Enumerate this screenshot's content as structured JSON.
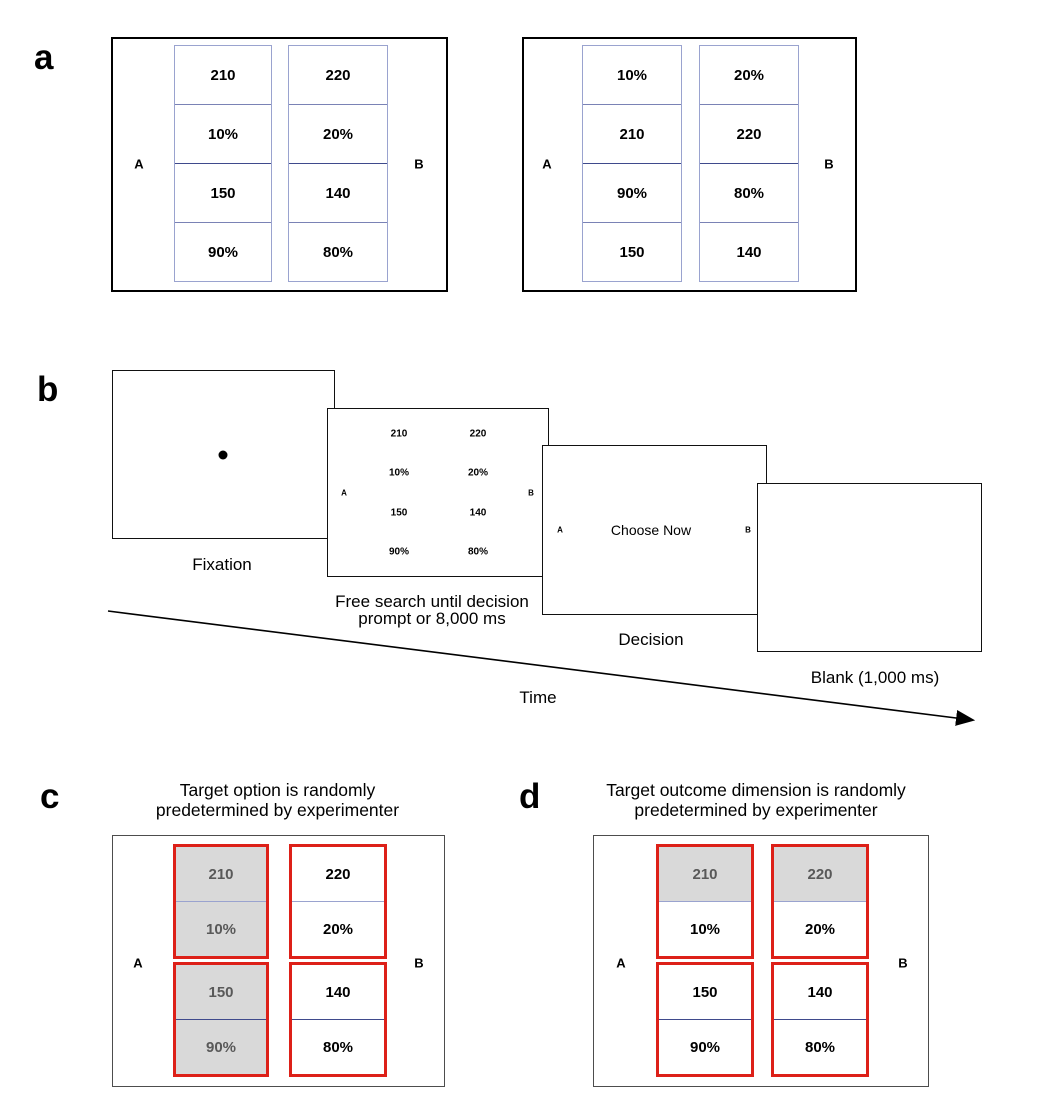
{
  "figure": {
    "panel_labels": {
      "a": "a",
      "b": "b",
      "c": "c",
      "d": "d"
    },
    "option_labels": {
      "A": "A",
      "B": "B"
    }
  },
  "panel_a": {
    "box1": {
      "colA": [
        "210",
        "10%",
        "150",
        "90%"
      ],
      "colB": [
        "220",
        "20%",
        "140",
        "80%"
      ]
    },
    "box2": {
      "colA": [
        "10%",
        "210",
        "90%",
        "150"
      ],
      "colB": [
        "20%",
        "220",
        "80%",
        "140"
      ]
    }
  },
  "panel_b": {
    "fixation_label": "Fixation",
    "search_label_line1": "Free search until decision",
    "search_label_line2": "prompt or 8,000 ms",
    "decision_label": "Decision",
    "blank_label": "Blank (1,000 ms)",
    "time_label": "Time",
    "choose_now": "Choose Now",
    "search_values": {
      "colA": [
        "210",
        "10%",
        "150",
        "90%"
      ],
      "colB": [
        "220",
        "20%",
        "140",
        "80%"
      ]
    }
  },
  "panel_c": {
    "title_line1": "Target option is randomly",
    "title_line2": "predetermined by experimenter",
    "colA": [
      "210",
      "10%",
      "150",
      "90%"
    ],
    "colB": [
      "220",
      "20%",
      "140",
      "80%"
    ]
  },
  "panel_d": {
    "title_line1": "Target outcome dimension is randomly",
    "title_line2": "predetermined by experimenter",
    "colA": [
      "210",
      "10%",
      "150",
      "90%"
    ],
    "colB": [
      "220",
      "20%",
      "140",
      "80%"
    ]
  },
  "colors": {
    "highlight_red": "#dd2018",
    "cell_gray_fill": "#d9d9d9",
    "gray_text": "#595959",
    "grid_light": "#9aa3cf",
    "grid_mid": "#7a82b5",
    "grid_dark": "#3f4a8c"
  }
}
